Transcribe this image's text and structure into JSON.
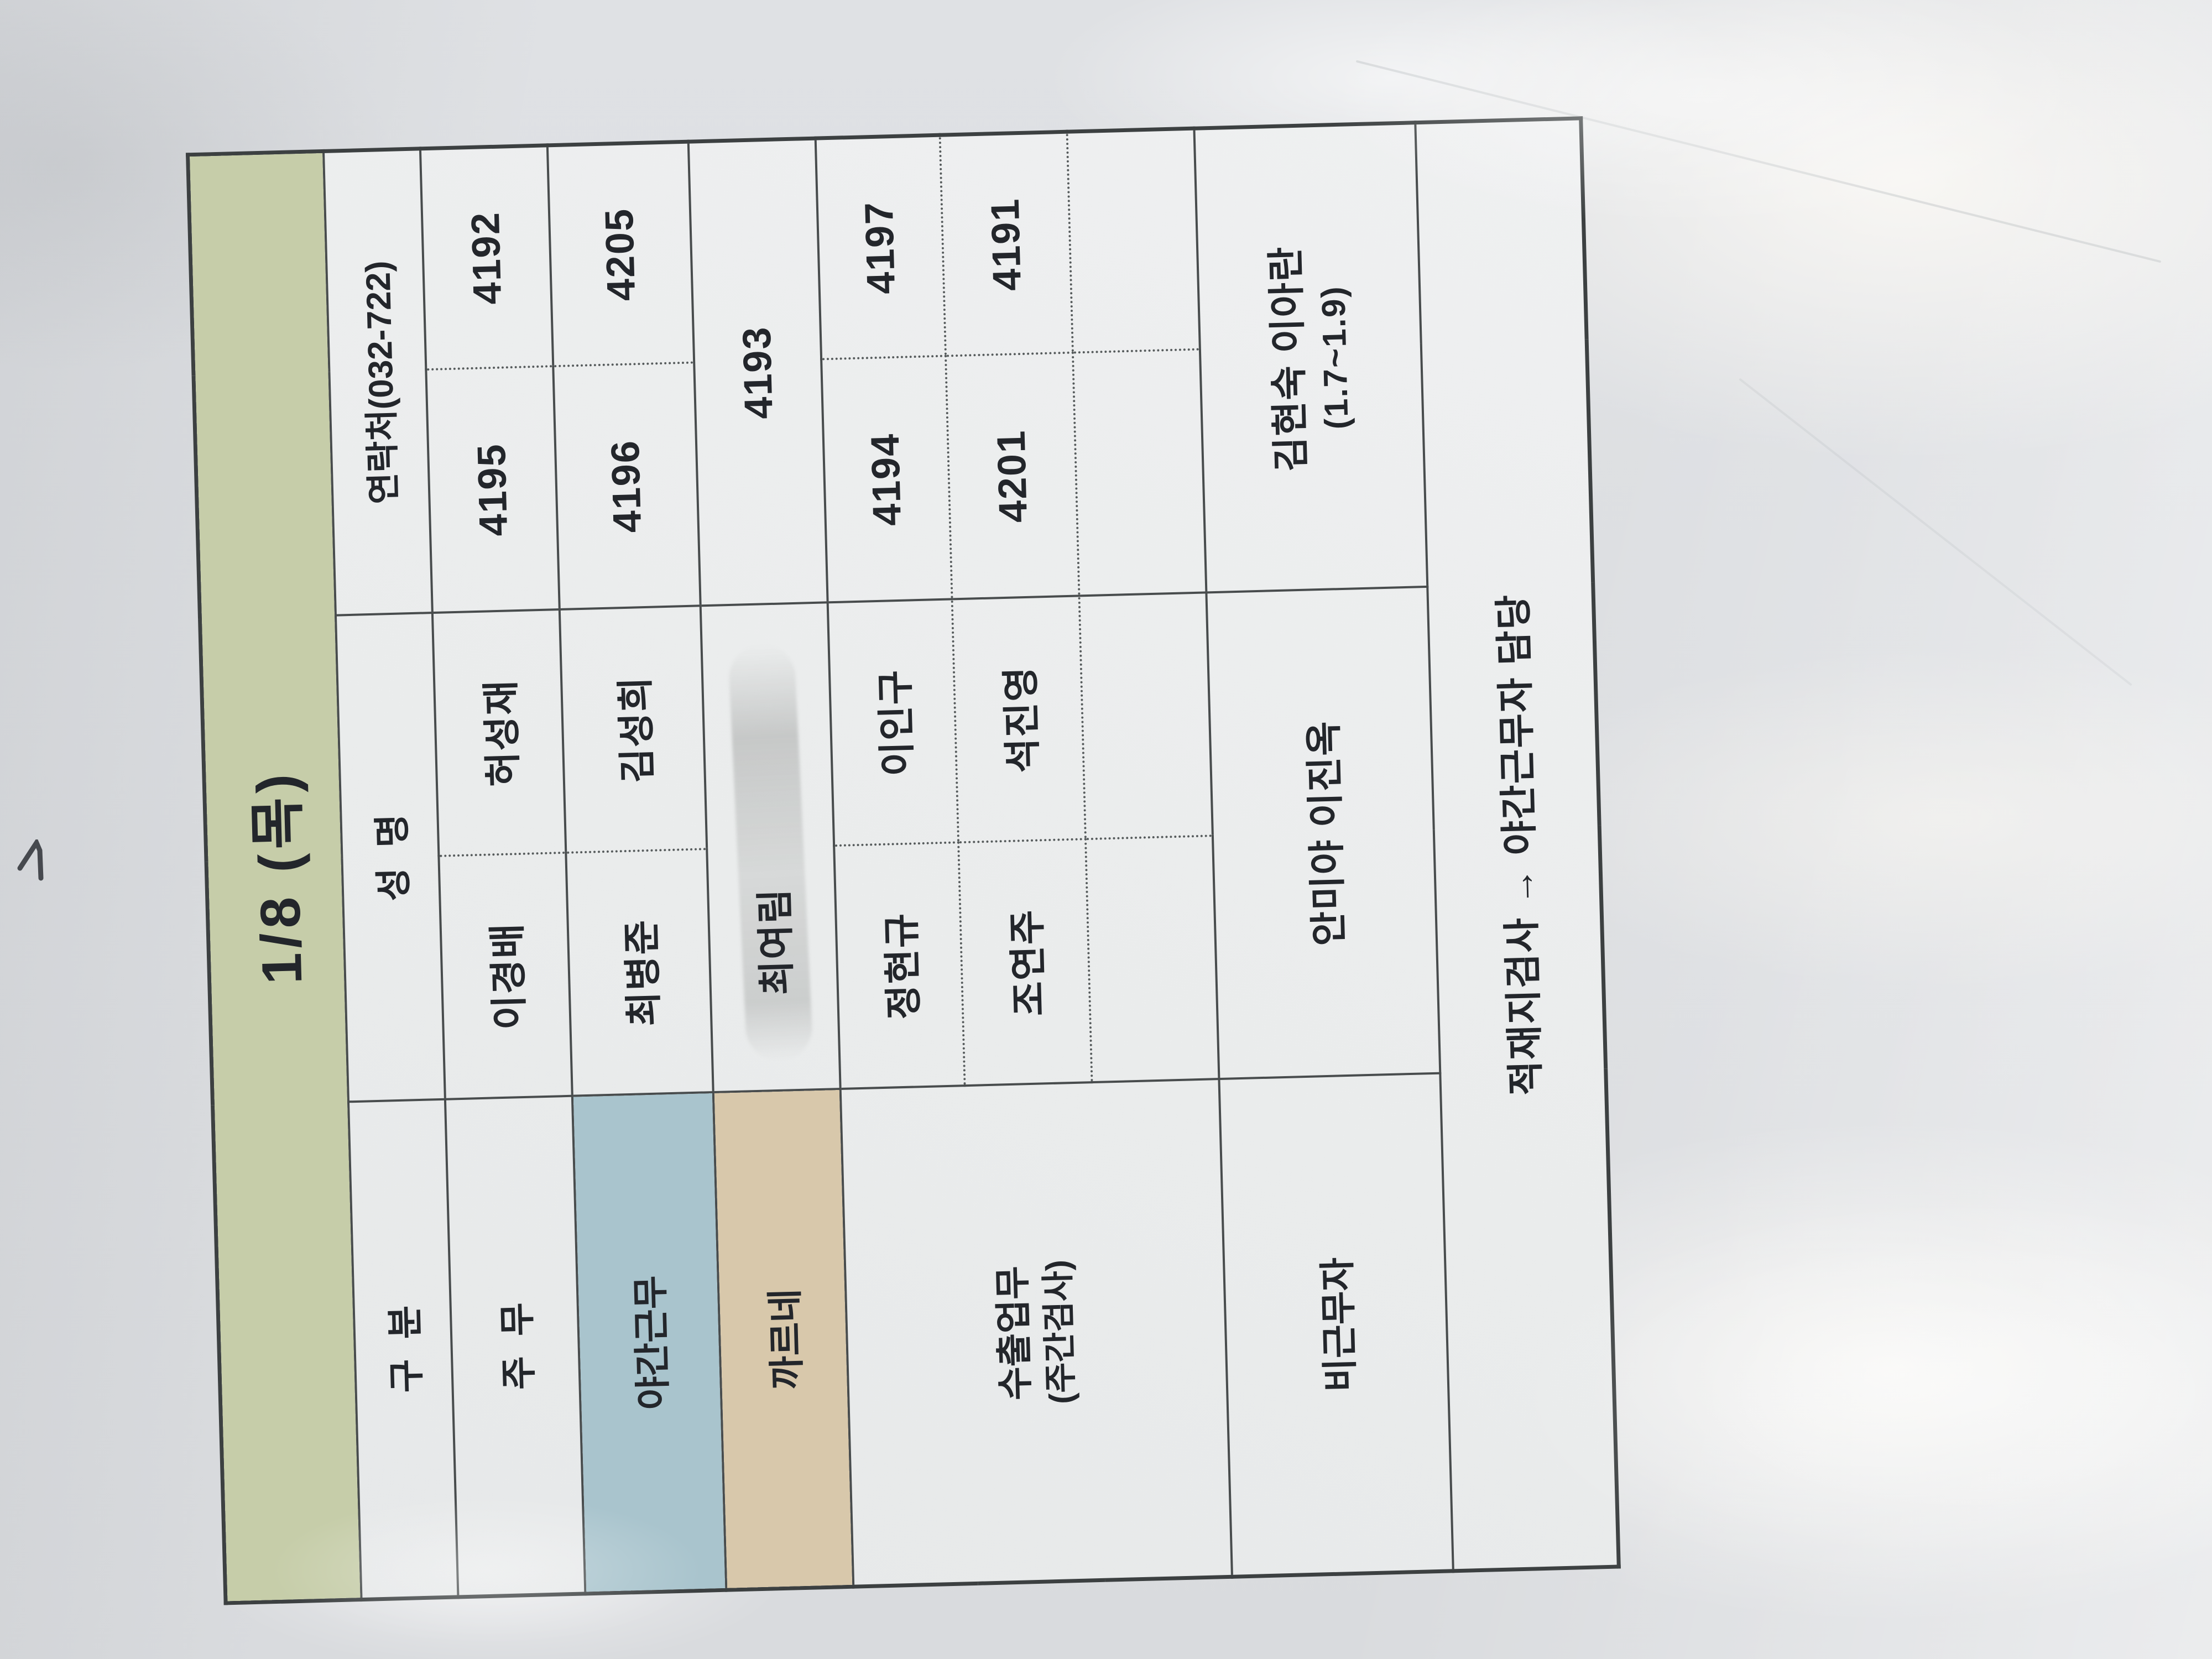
{
  "table": {
    "title": "1/8 (목)",
    "headers": {
      "category": "구분",
      "name": "성명",
      "contact": "연락처(032-722)"
    },
    "rows": [
      {
        "category": "주무",
        "names": [
          "이경배",
          "허성재"
        ],
        "contacts": [
          "4195",
          "4192"
        ]
      },
      {
        "category": "야간근무",
        "names": [
          "최병준",
          "김성희"
        ],
        "contacts": [
          "4196",
          "4205"
        ]
      },
      {
        "category": "까르네",
        "name": "최여림",
        "contact": "4193"
      },
      {
        "category": "수출업무",
        "category_sub": "(주간검사)",
        "names": [
          "정현규",
          "이인구"
        ],
        "contacts": [
          "4194",
          "4197"
        ]
      },
      {
        "names": [
          "조연주",
          "석진영"
        ],
        "contacts": [
          "4201",
          "4191"
        ]
      },
      {
        "names": [
          "",
          ""
        ],
        "contacts": [
          "",
          ""
        ]
      },
      {
        "category": "비근무자",
        "name": "안미야 이진옥",
        "contact_line1": "김현숙 이아란",
        "contact_line2": "(1.7~1.9)"
      }
    ],
    "footer_note": "적재지검사 → 야간근무자 담당"
  },
  "colors": {
    "title_bg": "#c6cda9",
    "night_shift_bg": "#a9c4cd",
    "carnet_bg": "#d8c8ab",
    "paper": "#dcdee1",
    "cell_bg": "#e9ebec",
    "grid_line": "#484c4d",
    "text": "#23262b"
  },
  "orientation": {
    "note": "table photographed rotated 90° counter-clockwise"
  }
}
